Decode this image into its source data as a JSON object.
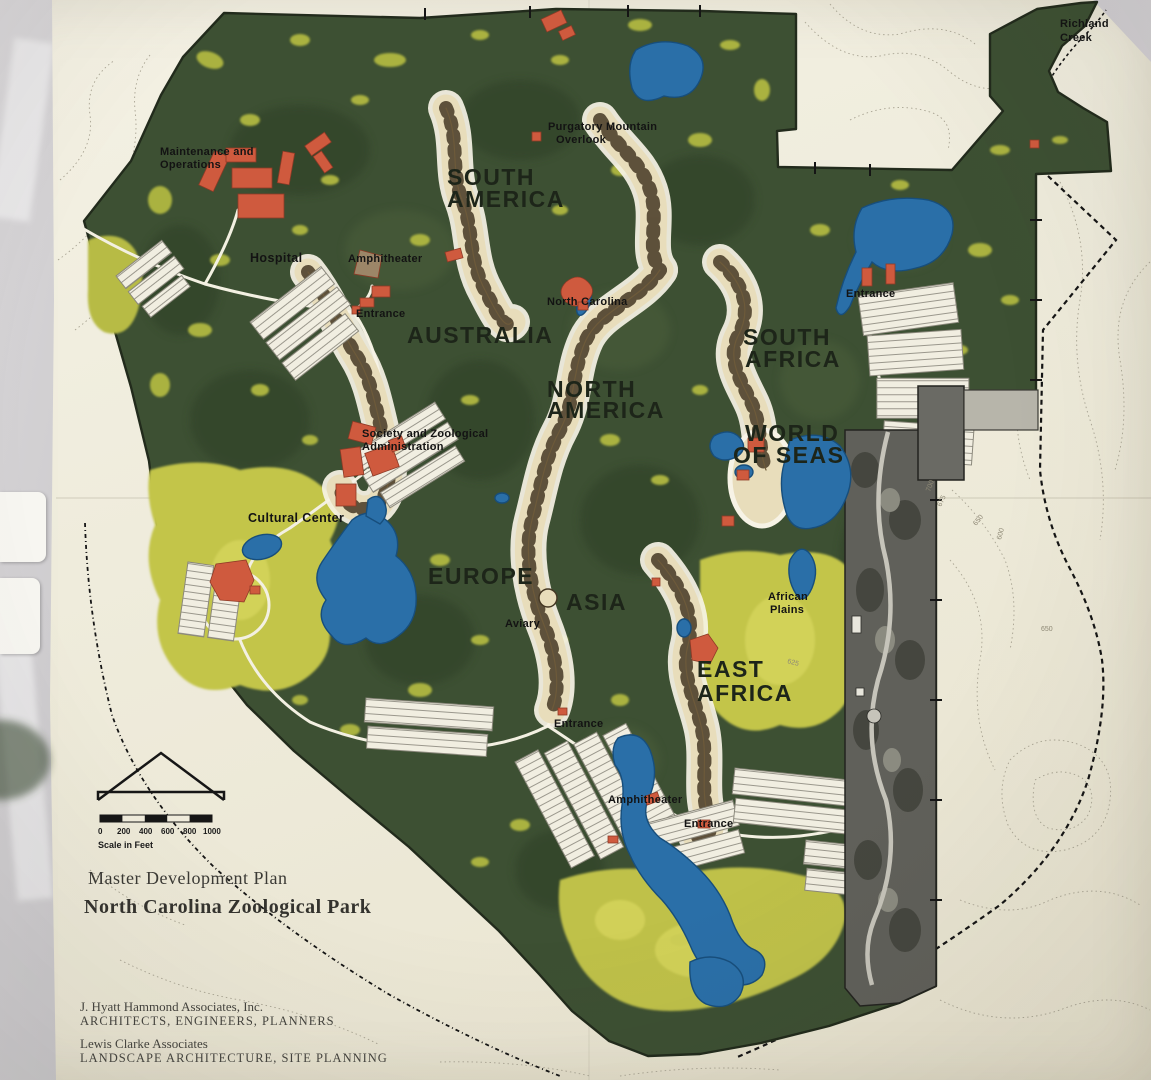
{
  "map": {
    "regions": {
      "south_america": [
        "SOUTH",
        "AMERICA"
      ],
      "australia": [
        "AUSTRALIA"
      ],
      "north_america": [
        "NORTH",
        "AMERICA"
      ],
      "south_africa": [
        "SOUTH",
        "AFRICA"
      ],
      "world_of_seas": [
        "WORLD",
        "OF SEAS"
      ],
      "europe": [
        "EUROPE"
      ],
      "asia": [
        "ASIA"
      ],
      "east_africa": [
        "EAST",
        "AFRICA"
      ]
    },
    "places": {
      "richland_creek": [
        "Richland",
        "Creek"
      ],
      "maintenance_operations": [
        "Maintenance and",
        "Operations"
      ],
      "hospital": "Hospital",
      "amphitheater_west": "Amphitheater",
      "entrance_west": "Entrance",
      "purgatory_overlook": [
        "Purgatory Mountain",
        "Overlook"
      ],
      "north_carolina": "North Carolina",
      "entrance_northeast": "Entrance",
      "society_administration": [
        "Society and Zoological",
        "Administration"
      ],
      "cultural_center": "Cultural Center",
      "aviary": "Aviary",
      "african_plains": [
        "African",
        "Plains"
      ],
      "entrance_south": "Entrance",
      "amphitheater_south": "Amphitheater",
      "entrance_southeast": "Entrance"
    },
    "contour_labels": [
      "700",
      "675",
      "650",
      "600",
      "650",
      "625"
    ],
    "scale_bar": {
      "tick_labels": [
        "0",
        "200",
        "400",
        "600",
        "800",
        "1000"
      ],
      "caption": "Scale in Feet"
    }
  },
  "title_block": {
    "plan_title": "Master Development Plan",
    "park_name": "North Carolina Zoological Park",
    "firm1_name": "J. Hyatt Hammond Associates, Inc.",
    "firm1_role": "ARCHITECTS, ENGINEERS, PLANNERS",
    "firm2_name": "Lewis Clarke Associates",
    "firm2_role": "LANDSCAPE ARCHITECTURE, SITE PLANNING"
  },
  "palette": {
    "paper": "#f0ecdc",
    "forest_green": "#3d5033",
    "meadow_yellow": "#bcbf47",
    "lake_blue": "#2a6fa8",
    "building_red": "#cf5a3e",
    "exhibit_cream": "#e9dfc0",
    "corridor_gray": "#60605a",
    "label_ink": "#1d2519"
  }
}
